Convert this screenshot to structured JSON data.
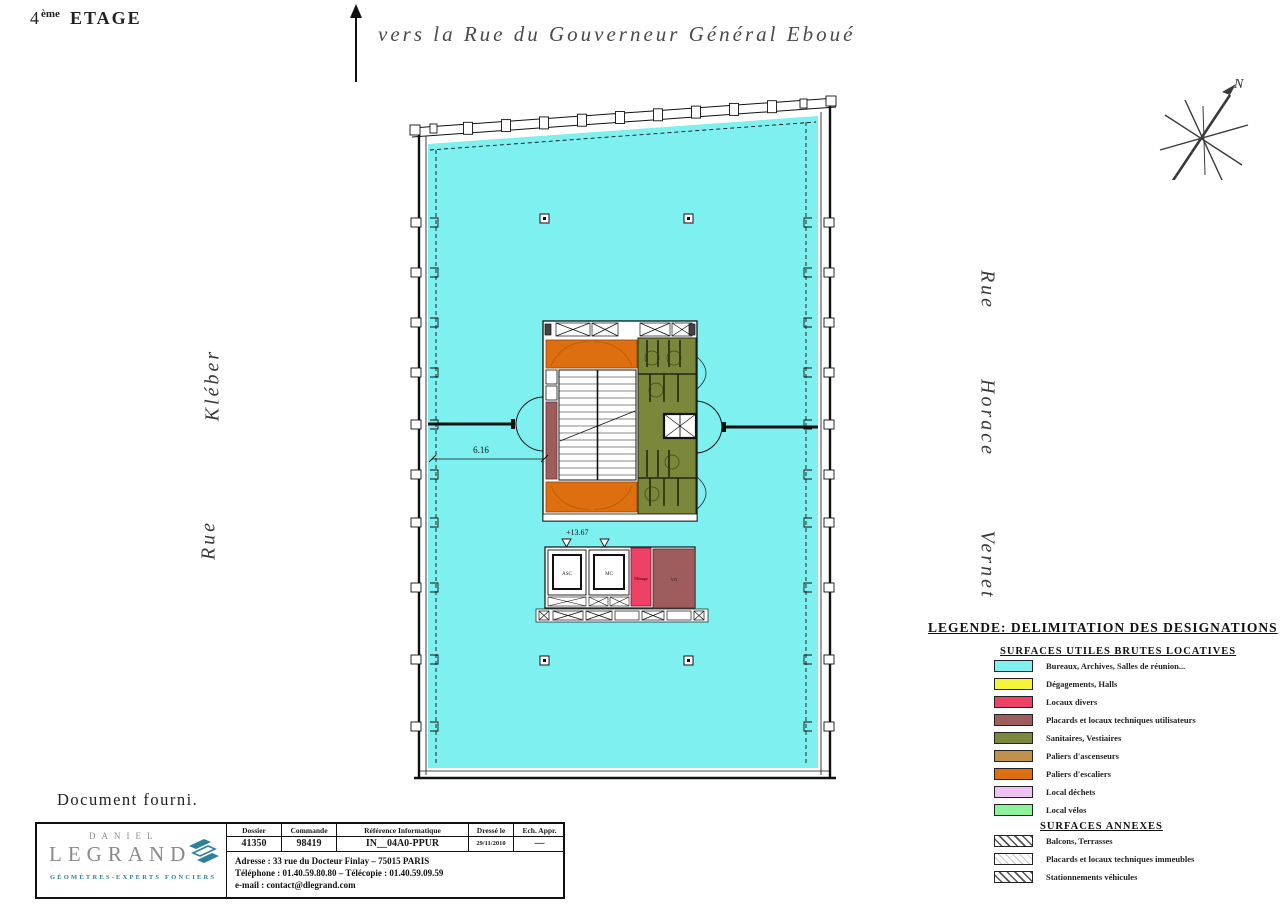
{
  "palette": {
    "cyan": "#7ef0f0",
    "yellow": "#f6f33c",
    "red": "#ee4166",
    "maroon": "#9e5c5c",
    "olive": "#7b873b",
    "tan": "#c08f4a",
    "orange": "#dd6f10",
    "violet": "#eec3f4",
    "green": "#8cf39b"
  },
  "header": {
    "floor_number": "4",
    "floor_suffix": "ème",
    "floor_word": "ETAGE",
    "direction_label": "vers la Rue du Gouverneur Général Eboué",
    "compass_north": "N"
  },
  "streets": {
    "left": [
      "Rue",
      "Kléber"
    ],
    "right": [
      "Rue",
      "Horace",
      "Vernet"
    ]
  },
  "plan": {
    "dimension": "6.16",
    "level": "+13.67",
    "labels": {
      "lift_a": "ASC",
      "lift_b": "MC",
      "cleaning": "Ménage",
      "duct": "VO"
    }
  },
  "legend": {
    "title": "LEGENDE: DELIMITATION DES DESIGNATIONS",
    "group1": "SURFACES UTILES BRUTES LOCATIVES",
    "group2": "SURFACES ANNEXES",
    "items": [
      {
        "color": "#7ef0f0",
        "label": "Bureaux, Archives, Salles de réunion..."
      },
      {
        "color": "#f6f33c",
        "label": "Dégagements, Halls"
      },
      {
        "color": "#ee4166",
        "label": "Locaux divers"
      },
      {
        "color": "#9e5c5c",
        "label": "Placards et locaux techniques utilisateurs"
      },
      {
        "color": "#7b873b",
        "label": "Sanitaires, Vestiaires"
      },
      {
        "color": "#c08f4a",
        "label": "Paliers d'ascenseurs"
      },
      {
        "color": "#dd6f10",
        "label": "Paliers d'escaliers"
      },
      {
        "color": "#eec3f4",
        "label": "Local déchets"
      },
      {
        "color": "#8cf39b",
        "label": "Local vélos"
      }
    ],
    "annex_items": [
      {
        "label": "Balcons, Terrasses",
        "hatch": "dark"
      },
      {
        "label": "Placards et locaux techniques immeubles",
        "hatch": "light"
      },
      {
        "label": "Stationnements véhicules",
        "hatch": "dark"
      }
    ]
  },
  "footer": {
    "note": "Document fourni.",
    "logo": {
      "line1": "DANIEL",
      "line2": "LEGRAND",
      "subtitle": "GÉOMÈTRES-EXPERTS FONCIERS"
    },
    "table": {
      "headers": [
        "Dossier",
        "Commande",
        "Référence Informatique",
        "Dressé le",
        "Ech. Appr."
      ],
      "values": [
        "41350",
        "98419",
        "IN__04A0-PPUR",
        "29/11/2010",
        "—"
      ]
    },
    "address_line": "Adresse : 33 rue du Docteur Finlay – 75015 PARIS",
    "phone_line": "Téléphone : 01.40.59.80.80  –  Télécopie : 01.40.59.09.59",
    "email_line": "e-mail : contact@dlegrand.com"
  }
}
